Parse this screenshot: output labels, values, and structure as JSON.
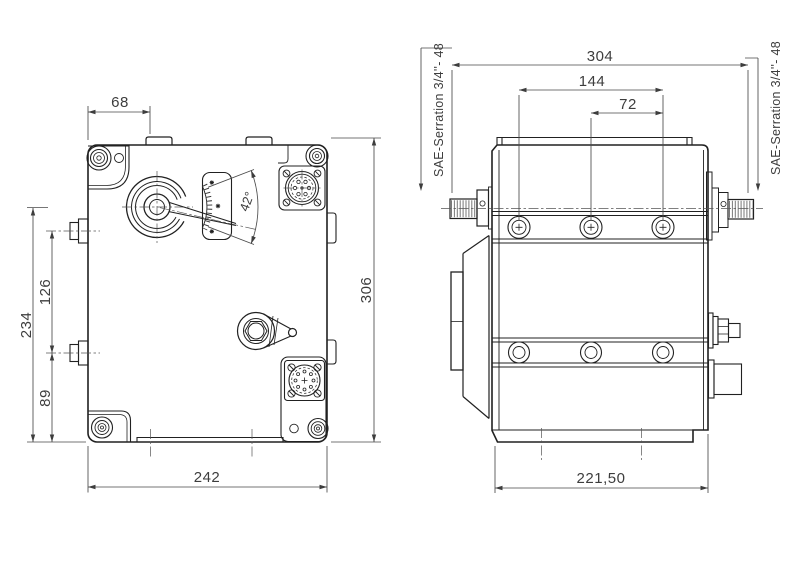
{
  "front_view": {
    "dims": {
      "top_width": "68",
      "left_total": "234",
      "boss_spacing": "126",
      "boss_to_bottom": "89",
      "bottom_width": "242",
      "right_height": "306",
      "lever_angle": "42°"
    }
  },
  "side_view": {
    "dims": {
      "top_width": "304",
      "screw_span": "144",
      "screw_pitch": "72",
      "bottom_depth": "221,50"
    },
    "spline_label_left": "SAE-Serration 3/4''- 48",
    "spline_label_right": "SAE-Serration 3/4''- 48"
  },
  "colors": {
    "line": "#212121",
    "dimension": "#4a4a4a",
    "background": "#ffffff"
  }
}
